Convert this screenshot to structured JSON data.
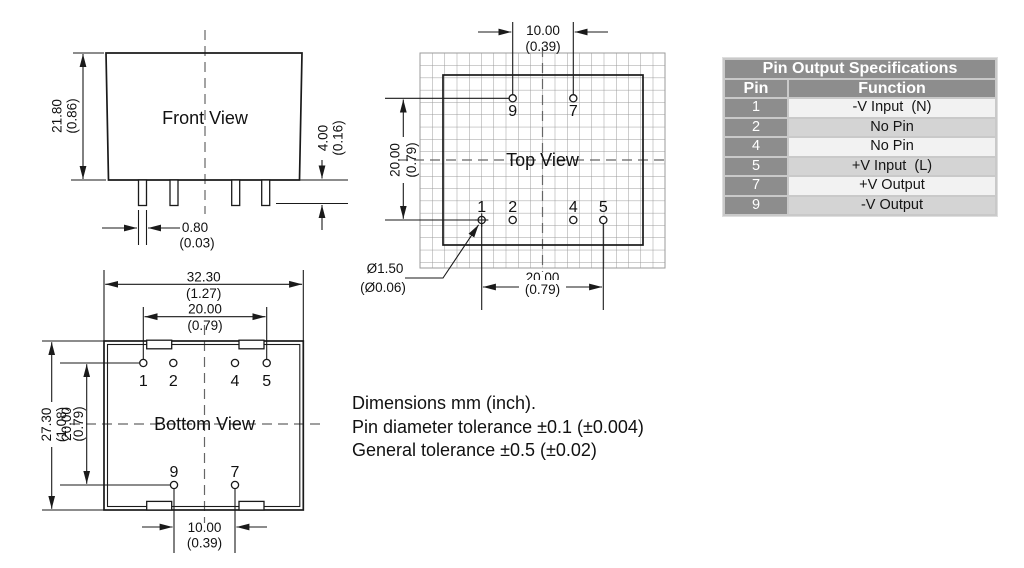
{
  "drawing": {
    "front_view": {
      "title": "Front View",
      "height_mm": "21.80",
      "height_in": "(0.86)",
      "pin_length_mm": "4.00",
      "pin_length_in": "(0.16)",
      "pin_width_mm": "0.80",
      "pin_width_in": "(0.03)"
    },
    "top_view": {
      "title": "Top View",
      "top_pitch_mm": "10.00",
      "top_pitch_in": "(0.39)",
      "row_span_mm": "20.00",
      "row_span_in": "(0.79)",
      "bottom_span_mm": "20.00",
      "bottom_span_in": "(0.79)",
      "pin_dia_mm": "Ø1.50",
      "pin_dia_in": "(Ø0.06)",
      "pins": {
        "p9": "9",
        "p7": "7",
        "p1": "1",
        "p2": "2",
        "p4": "4",
        "p5": "5"
      }
    },
    "bottom_view": {
      "title": "Bottom View",
      "width_mm": "32.30",
      "width_in": "(1.27)",
      "top_span_mm": "20.00",
      "top_span_in": "(0.79)",
      "height_mm": "27.30",
      "height_in": "(1.08)",
      "left_span_mm": "20.00",
      "left_span_in": "(0.79)",
      "bottom_pitch_mm": "10.00",
      "bottom_pitch_in": "(0.39)",
      "pins": {
        "p1": "1",
        "p2": "2",
        "p4": "4",
        "p5": "5",
        "p9": "9",
        "p7": "7"
      }
    }
  },
  "notes": {
    "line1": "Dimensions mm (inch).",
    "line2": "Pin diameter tolerance ±0.1 (±0.004)",
    "line3": "General tolerance ±0.5 (±0.02)"
  },
  "pin_table": {
    "title": "Pin Output Specifications",
    "col_pin": "Pin",
    "col_function": "Function",
    "rows": [
      {
        "pin": "1",
        "function": "-V Input  (N)"
      },
      {
        "pin": "2",
        "function": "No Pin"
      },
      {
        "pin": "4",
        "function": "No Pin"
      },
      {
        "pin": "5",
        "function": "+V Input  (L)"
      },
      {
        "pin": "7",
        "function": "+V Output"
      },
      {
        "pin": "9",
        "function": "-V Output"
      }
    ]
  },
  "colors": {
    "line": "#1a1a1a",
    "grid": "#9b9b9b",
    "centerline": "#666666",
    "table_header_bg": "#8d8d8d",
    "table_row_light": "#f2f2f2",
    "table_row_dark": "#d4d4d4",
    "table_frame": "#c9c9c9"
  }
}
